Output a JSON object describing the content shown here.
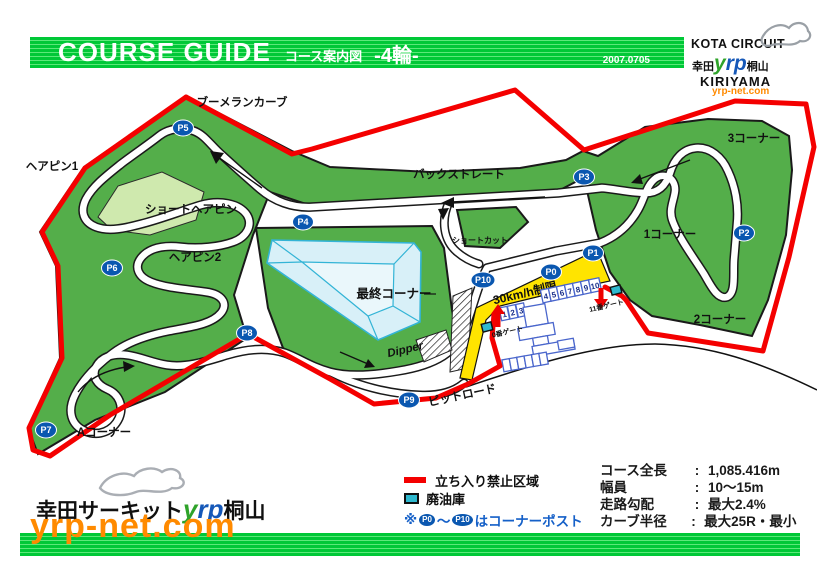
{
  "header": {
    "title": "COURSE GUIDE",
    "subtitle": "コース案内図",
    "category": "-4輪-",
    "date": "2007.0705"
  },
  "brand": {
    "name_top": "KOTA CIRCUIT",
    "kanji_left": "幸田",
    "yrp_y": "y",
    "yrp_rp": "rp",
    "kanji_right": "桐山",
    "name_bottom": "KIRIYAMA",
    "url": "yrp-net.com"
  },
  "map": {
    "labels": {
      "boomerang": "ブーメランカーブ",
      "hairpin1": "ヘアピン1",
      "short_hairpin": "ショートヘアピン",
      "hairpin2": "ヘアピン2",
      "back_straight": "バックストレート",
      "corner3": "3コーナー",
      "corner1": "1コーナー",
      "corner2": "2コーナー",
      "shortcut": "ショートカット",
      "final_corner": "最終コーナー",
      "dipper": "Dipper",
      "a_corner": "Aコーナー",
      "pit_road": "ピットロード",
      "speed_limit": "30km/h制限",
      "gate0": "0番ゲート",
      "gate11": "11番ゲート"
    },
    "posts": [
      "P0",
      "P1",
      "P2",
      "P3",
      "P4",
      "P5",
      "P6",
      "P7",
      "P8",
      "P9",
      "P10"
    ],
    "pit_numbers": [
      "1",
      "2",
      "3",
      "4",
      "5",
      "6",
      "7",
      "8",
      "9",
      "10"
    ]
  },
  "legend": {
    "restricted": "立ち入り禁止区域",
    "oil": "廃油庫",
    "note_mark": "※",
    "tilde": "〜",
    "note_text": "はコーナーポスト"
  },
  "stats": {
    "separator": ":",
    "rows": [
      {
        "label": "コース全長",
        "value": "1,085.416m"
      },
      {
        "label": "幅員",
        "value": "10〜15m"
      },
      {
        "label": "走路勾配",
        "value": "最大2.4%"
      },
      {
        "label": "カーブ半径",
        "value": "最大25R・最小10R"
      }
    ]
  },
  "footer": {
    "name_left": "幸田サーキット",
    "yrp_y": "y",
    "yrp_rp": "rp",
    "name_right": "桐山",
    "url": "yrp-net.com"
  },
  "colors": {
    "banner_green": "#00c837",
    "grass": "#54ae4a",
    "pale_green": "#cfe9ae",
    "pond_fill": "#d8f0f8",
    "pond_line": "#33b4d6",
    "pit_yellow": "#ffe400",
    "restricted_red": "#f40000",
    "post_blue": "#0a57b0",
    "oil_teal": "#2fb9cf",
    "building_blue": "#4a66cc",
    "note_blue": "#1560c8",
    "url_orange": "#ff8a00"
  }
}
